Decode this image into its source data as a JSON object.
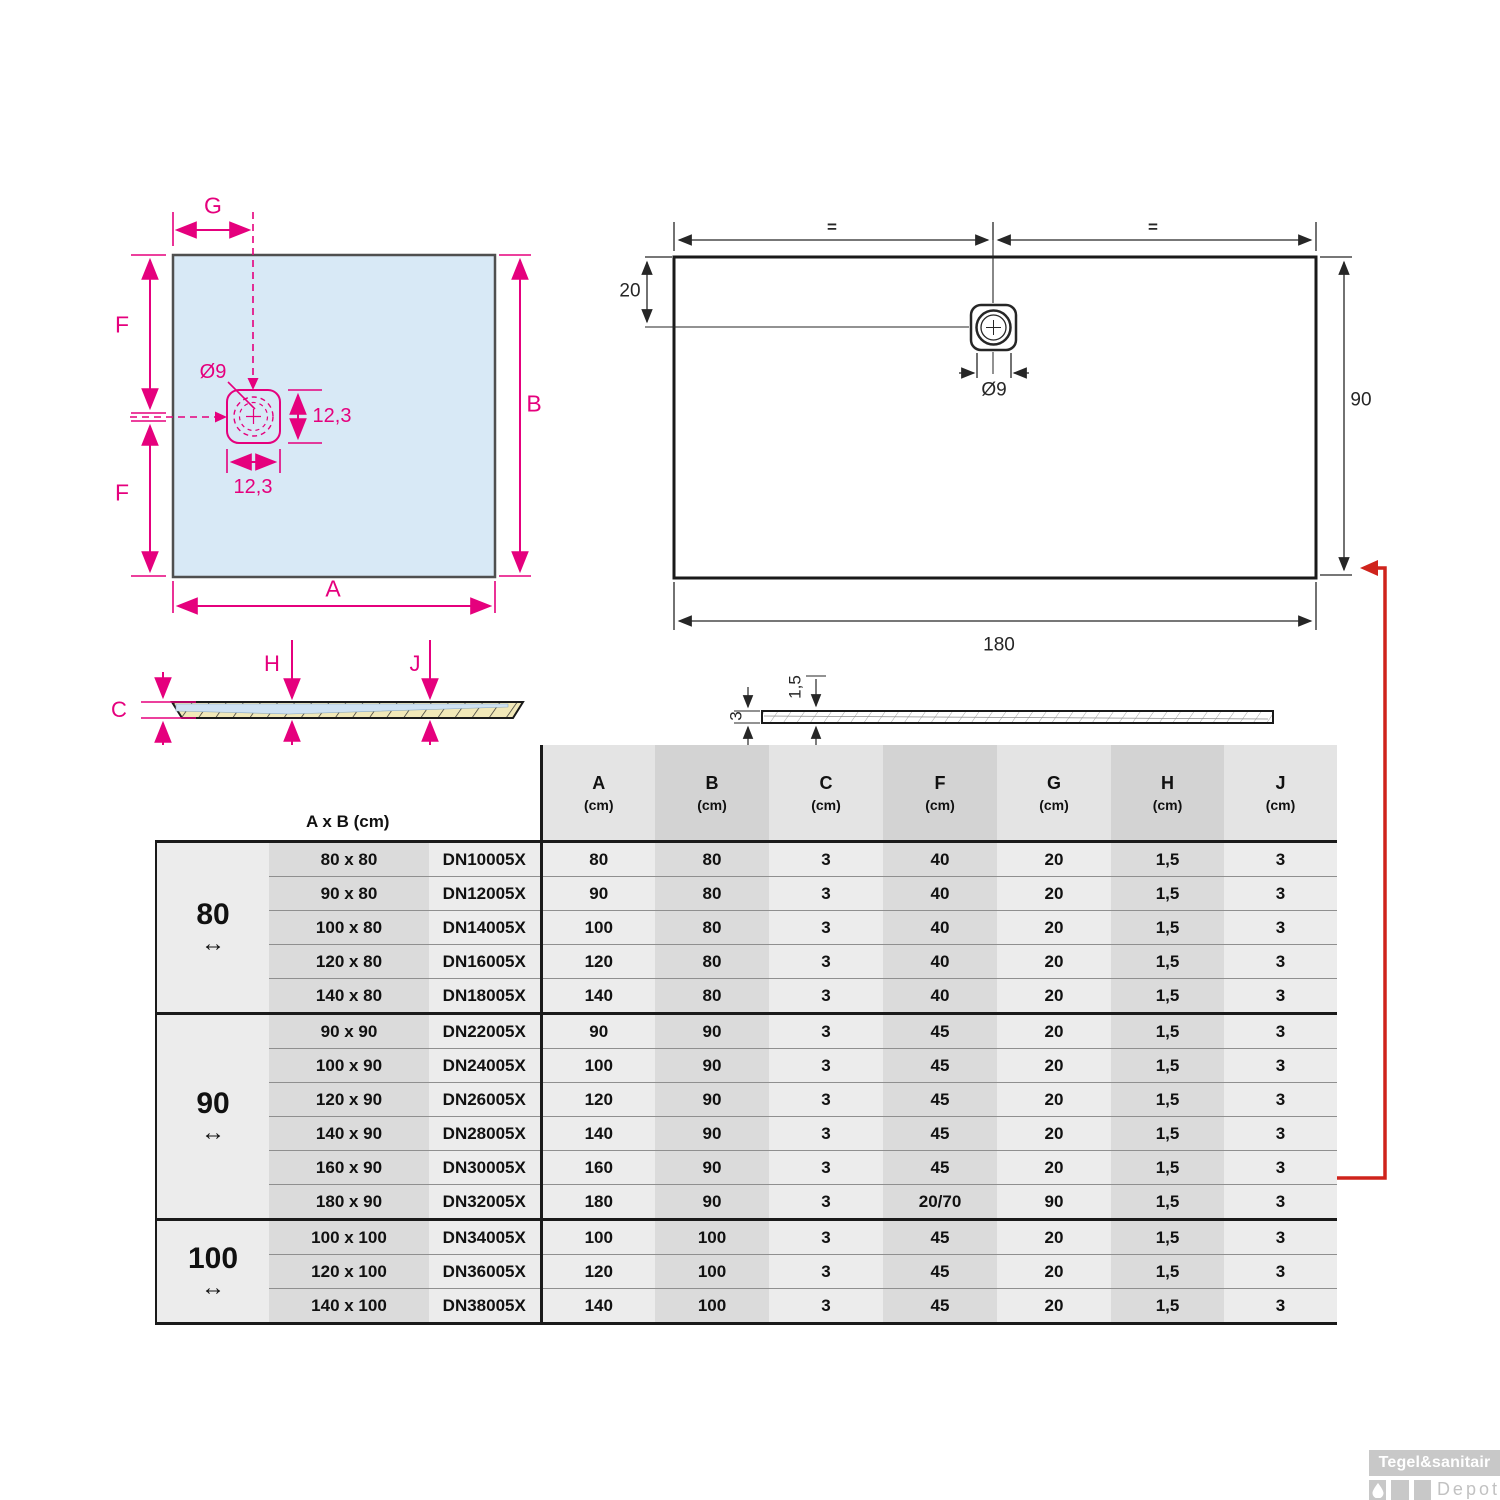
{
  "plan_square": {
    "labels": {
      "g": "G",
      "f_top": "F",
      "f_bottom": "F",
      "b": "B",
      "a": "A",
      "drain_diameter": "Ø9",
      "drain_height": "12,3",
      "drain_width": "12,3"
    }
  },
  "plan_rect": {
    "labels": {
      "eq_left": "=",
      "eq_right": "=",
      "offset_top": "20",
      "drain_diameter": "Ø9",
      "height": "90",
      "width": "180"
    }
  },
  "section_left": {
    "labels": {
      "c": "C",
      "h": "H",
      "j": "J"
    }
  },
  "section_right": {
    "labels": {
      "depth": "1,5",
      "thickness": "3"
    }
  },
  "table": {
    "corner_header": "A x B (cm)",
    "columns": [
      {
        "letter": "A",
        "unit": "(cm)"
      },
      {
        "letter": "B",
        "unit": "(cm)"
      },
      {
        "letter": "C",
        "unit": "(cm)"
      },
      {
        "letter": "F",
        "unit": "(cm)"
      },
      {
        "letter": "G",
        "unit": "(cm)"
      },
      {
        "letter": "H",
        "unit": "(cm)"
      },
      {
        "letter": "J",
        "unit": "(cm)"
      }
    ],
    "groups": [
      {
        "label": "80",
        "arrow": "↔",
        "rows": [
          [
            "80 x 80",
            "DN10005X",
            "80",
            "80",
            "3",
            "40",
            "20",
            "1,5",
            "3"
          ],
          [
            "90 x 80",
            "DN12005X",
            "90",
            "80",
            "3",
            "40",
            "20",
            "1,5",
            "3"
          ],
          [
            "100 x 80",
            "DN14005X",
            "100",
            "80",
            "3",
            "40",
            "20",
            "1,5",
            "3"
          ],
          [
            "120 x 80",
            "DN16005X",
            "120",
            "80",
            "3",
            "40",
            "20",
            "1,5",
            "3"
          ],
          [
            "140 x 80",
            "DN18005X",
            "140",
            "80",
            "3",
            "40",
            "20",
            "1,5",
            "3"
          ]
        ]
      },
      {
        "label": "90",
        "arrow": "↔",
        "rows": [
          [
            "90 x 90",
            "DN22005X",
            "90",
            "90",
            "3",
            "45",
            "20",
            "1,5",
            "3"
          ],
          [
            "100 x 90",
            "DN24005X",
            "100",
            "90",
            "3",
            "45",
            "20",
            "1,5",
            "3"
          ],
          [
            "120 x 90",
            "DN26005X",
            "120",
            "90",
            "3",
            "45",
            "20",
            "1,5",
            "3"
          ],
          [
            "140 x 90",
            "DN28005X",
            "140",
            "90",
            "3",
            "45",
            "20",
            "1,5",
            "3"
          ],
          [
            "160 x 90",
            "DN30005X",
            "160",
            "90",
            "3",
            "45",
            "20",
            "1,5",
            "3"
          ],
          [
            "180 x 90",
            "DN32005X",
            "180",
            "90",
            "3",
            "20/70",
            "90",
            "1,5",
            "3"
          ]
        ]
      },
      {
        "label": "100",
        "arrow": "↔",
        "rows": [
          [
            "100 x 100",
            "DN34005X",
            "100",
            "100",
            "3",
            "45",
            "20",
            "1,5",
            "3"
          ],
          [
            "120 x 100",
            "DN36005X",
            "120",
            "100",
            "3",
            "45",
            "20",
            "1,5",
            "3"
          ],
          [
            "140 x 100",
            "DN38005X",
            "140",
            "100",
            "3",
            "45",
            "20",
            "1,5",
            "3"
          ]
        ]
      }
    ]
  },
  "watermark": {
    "brand": "Tegel&sanitair",
    "sub": "Depot"
  },
  "colors": {
    "magenta": "#e5007d",
    "red_arrow": "#cf231c",
    "tray_fill": "#d8e9f6",
    "hatch_yellow": "#f1e8b8",
    "stripe_dark": "#dbdbdb",
    "stripe_light": "#ececec"
  }
}
